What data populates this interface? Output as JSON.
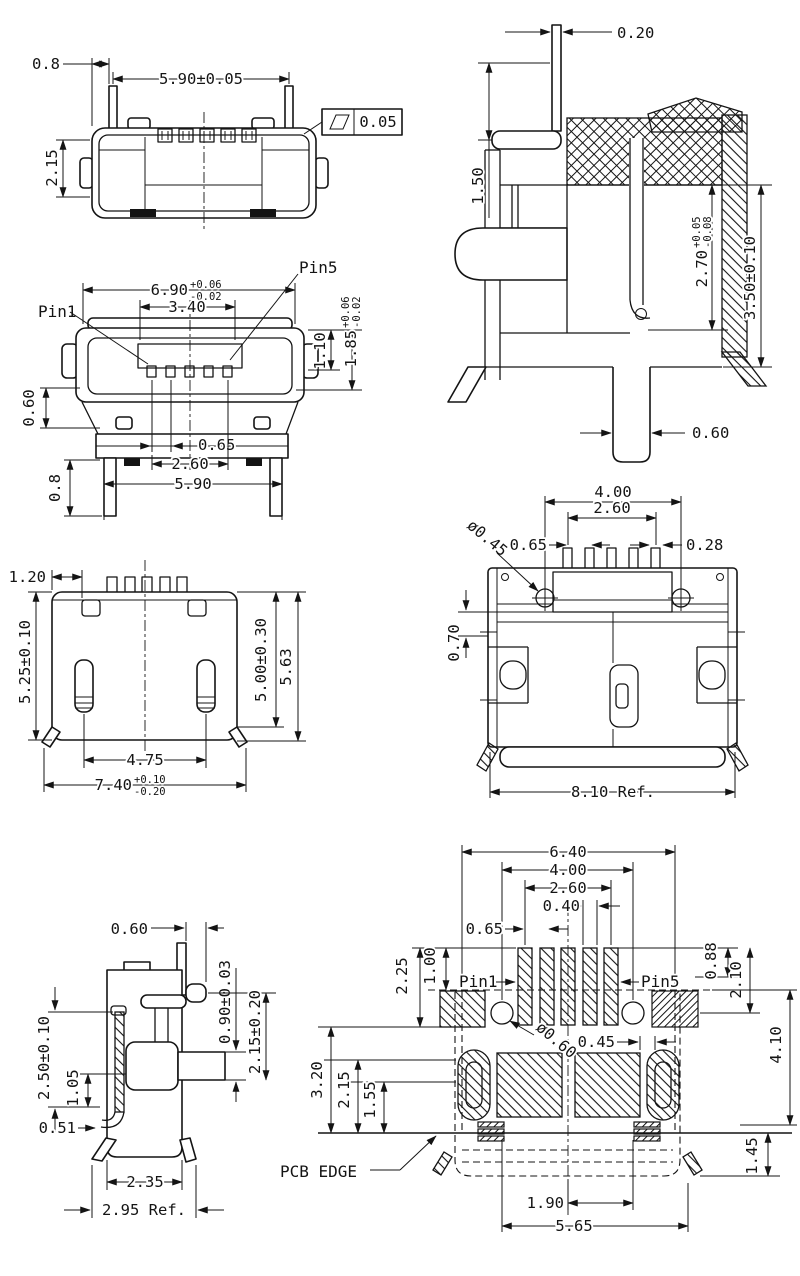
{
  "views": {
    "top": {
      "dims": {
        "offset": "0.8",
        "width": "5.90±0.05",
        "depth": "2.15",
        "flatness": "0.05"
      }
    },
    "section": {
      "dims": {
        "pin_w": "0.20",
        "lead_h": "1.50",
        "inner_h": "2.70",
        "inner_h_plus": "+0.05",
        "inner_h_minus": "-0.08",
        "shell_h": "3.50±0.10",
        "pin_b": "0.60"
      }
    },
    "front": {
      "labels": {
        "pin1": "Pin1",
        "pin5": "Pin5"
      },
      "dims": {
        "shell_w": "6.90",
        "shell_w_plus": "+0.06",
        "shell_w_minus": "-0.02",
        "tongue_w": "3.40",
        "opening_h": "1.10",
        "shell_h": "1.85",
        "shell_h_plus": "+0.06",
        "shell_h_minus": "-0.02",
        "wing": "0.60",
        "leg": "0.8",
        "pitch": "0.65",
        "contact_span": "2.60",
        "leg_span": "5.90"
      }
    },
    "bottom": {
      "dims": {
        "edge": "1.20",
        "height_left": "5.25±0.10",
        "height_right": "5.00±0.30",
        "height_overall": "5.63",
        "pad_span": "4.75",
        "width": "7.40",
        "width_plus": "+0.10",
        "width_minus": "-0.20"
      }
    },
    "rear": {
      "dims": {
        "hole_span": "4.00",
        "pin_span": "2.60",
        "pitch": "0.65",
        "hole_dia": "ø0.45",
        "pin_w": "0.28",
        "seat": "0.70",
        "overall": "8.10 Ref."
      }
    },
    "side": {
      "dims": {
        "pin_off": "0.60",
        "stem_h": "0.90±0.03",
        "stem_pos": "2.15±0.20",
        "shell_h": "2.50±0.10",
        "inner_h": "1.05",
        "curl": "0.51",
        "body_d": "2.35",
        "overall_d": "2.95 Ref."
      }
    },
    "pcb": {
      "labels": {
        "pin1": "Pin1",
        "pin5": "Pin5",
        "edge": "PCB EDGE"
      },
      "dims": {
        "pad_outer_span": "6.40",
        "hole_span": "4.00",
        "pad_span": "2.60",
        "pad_w": "0.40",
        "pitch": "0.65",
        "col_a": "2.25",
        "col_b": "1.00",
        "row_a": "0.88",
        "row_b": "2.10",
        "depth": "4.10",
        "hole_dia": "ø0.60",
        "gap": "0.45",
        "d1": "3.20",
        "d2": "2.15",
        "d3": "1.55",
        "slot_span": "1.90",
        "shield_span": "5.65",
        "edge_off": "1.45"
      }
    }
  }
}
